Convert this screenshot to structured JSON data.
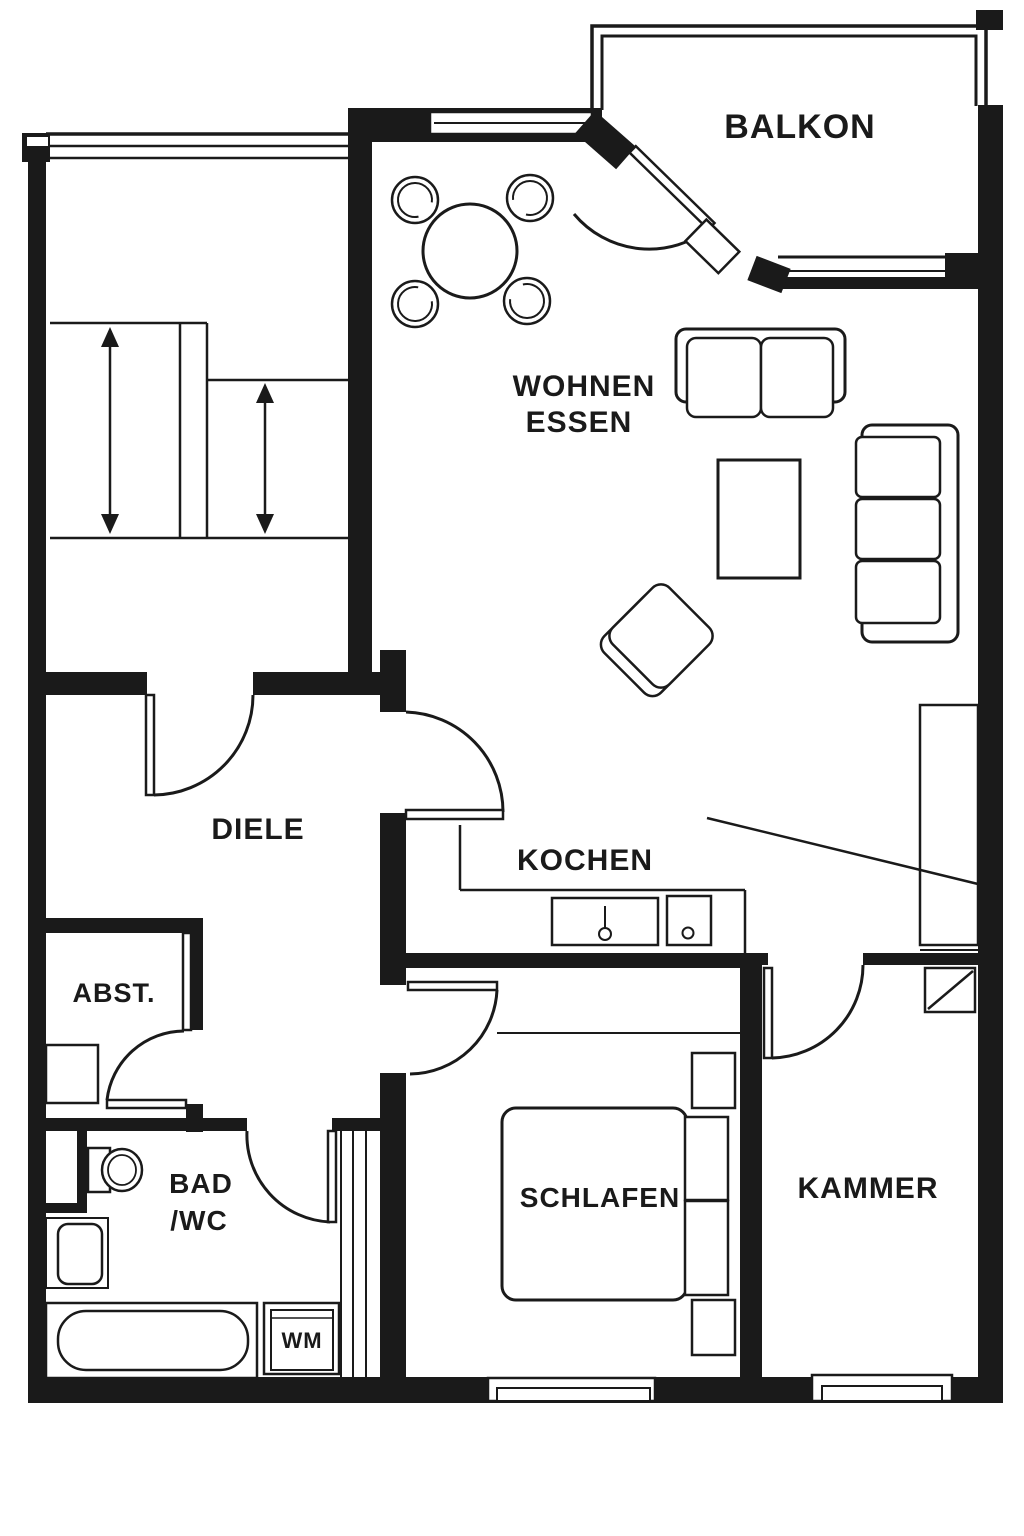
{
  "document": {
    "type": "apartment-floor-plan"
  },
  "colors": {
    "wall": "#1a1a1a",
    "background": "#ffffff",
    "line": "#1a1a1a"
  },
  "rooms": {
    "balkon": {
      "label": "BALKON"
    },
    "wohnen_essen": {
      "label_line1": "WOHNEN",
      "label_line2": "ESSEN"
    },
    "diele": {
      "label": "DIELE"
    },
    "kochen": {
      "label": "KOCHEN"
    },
    "abstellraum": {
      "label": "ABST."
    },
    "bad_wc": {
      "label_line1": "BAD",
      "label_line2": "/WC"
    },
    "schlafen": {
      "label": "SCHLAFEN"
    },
    "kammer": {
      "label": "KAMMER"
    }
  },
  "appliances": {
    "washing_machine": {
      "label": "WM"
    }
  }
}
